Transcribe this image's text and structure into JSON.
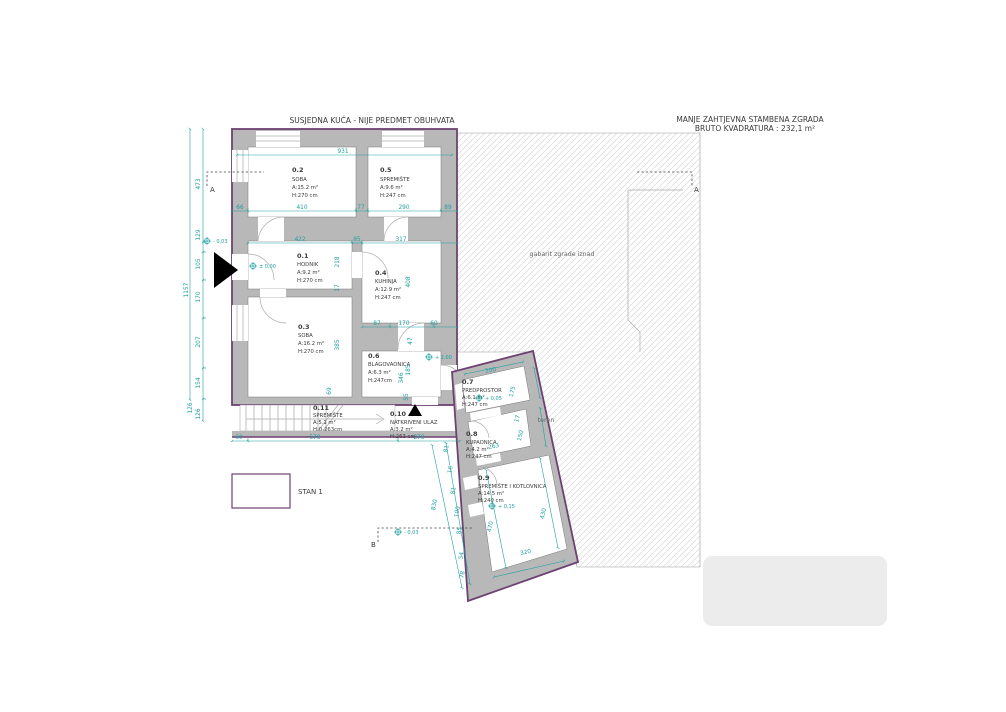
{
  "header": {
    "top_note": "SUSJEDNA KUĆA - NIJE PREDMET OBUHVATA",
    "right_note_line1": "MANJE ZAHTJEVNA STAMBENA ZGRADA",
    "right_note_line2": "BRUTO KVADRATURA : 232,1 m²"
  },
  "labels": {
    "gabarit": "gabarit zgrade iznad",
    "teren": "teren",
    "legend_stan": "STAN 1"
  },
  "sections": {
    "a_left": "A",
    "a_right": "A",
    "b": "B"
  },
  "levels": {
    "entry_outside": "- 0,03",
    "hodnik": "± 0,00",
    "blagovaonica": "+ 2,00",
    "predprostor": "+ 0,05",
    "kotlovnica": "+ 0,15",
    "section_b": "- 0,03"
  },
  "rooms": [
    {
      "id": "0.1",
      "name": "HODNIK",
      "area": "A:9.2 m²",
      "height": "H:270 cm"
    },
    {
      "id": "0.2",
      "name": "SOBA",
      "area": "A:15.2 m²",
      "height": "H:270  cm"
    },
    {
      "id": "0.3",
      "name": "SOBA",
      "area": "A:16.2 m²",
      "height": "H:270  cm"
    },
    {
      "id": "0.4",
      "name": "KUHINJA",
      "area": "A:12.9 m²",
      "height": "H:247  cm"
    },
    {
      "id": "0.5",
      "name": "SPREMIŠTE",
      "area": "A:9.6 m²",
      "height": "H:247 cm"
    },
    {
      "id": "0.6",
      "name": "BLAGOVAONICA",
      "area": "A:6.3 m²",
      "height": "H:247cm"
    },
    {
      "id": "0.7",
      "name": "PREDPROSTOR",
      "area": "A:6.1  m²",
      "height": "H:247  cm"
    },
    {
      "id": "0.8",
      "name": "KUPAONICA",
      "area": "A:4.2  m²",
      "height": "H:247  cm"
    },
    {
      "id": "0.9",
      "name": "SPREMIŠTE I KOTLOVNICA",
      "area": "A:14.5 m²",
      "height": "H:240  cm"
    },
    {
      "id": "0.10",
      "name": "NATKRIVENI ULAZ",
      "area": "A:3.2  m²",
      "height": "H:263  cm"
    },
    {
      "id": "0.11",
      "name": "SPREMIŠTE",
      "area": "A:5.1 m²",
      "height": "H:0-263cm"
    }
  ],
  "dims": {
    "total_top": "931",
    "left_total": "1157",
    "t66": "66",
    "t410": "410",
    "t77": "77",
    "t290": "290",
    "t89": "89",
    "m422": "422",
    "m85": "85",
    "m317": "317",
    "v218": "218",
    "v17": "17",
    "v385": "385",
    "v69": "69",
    "v408": "408",
    "k87": "87",
    "k170": "170",
    "k60": "60",
    "v47": "47",
    "v346": "346",
    "v185": "185",
    "v55": "55",
    "l473": "473",
    "l129": "129",
    "l105": "105",
    "l170": "170",
    "l207": "207",
    "l154": "154",
    "l126a": "126",
    "l126b": "126",
    "b60": "60",
    "b578": "578",
    "b278": "278",
    "w200": "200",
    "w175": "175",
    "w17": "17",
    "w150": "150",
    "w263": "263",
    "s830": "830",
    "s81a": "81",
    "s16": "16",
    "s81b": "81",
    "s100": "100",
    "s85": "85",
    "s54": "54",
    "s78": "78",
    "n470": "470",
    "n430": "430",
    "n320": "320"
  }
}
